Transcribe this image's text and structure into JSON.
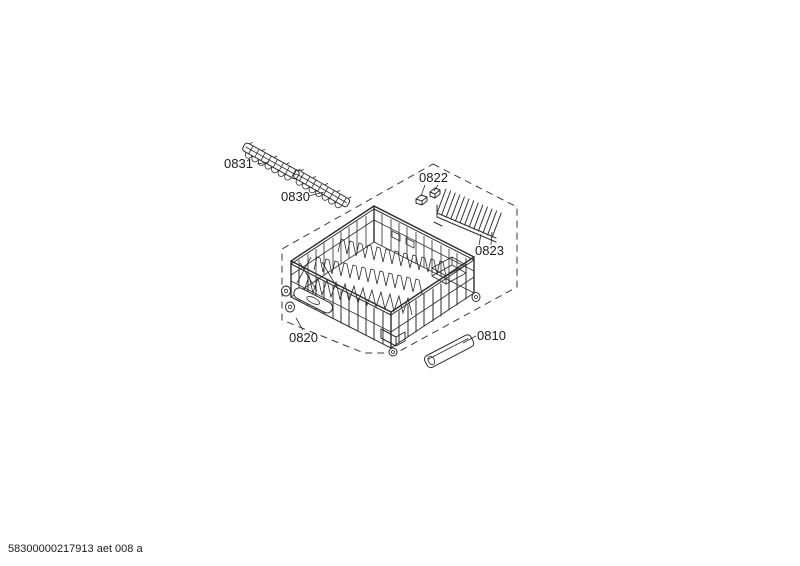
{
  "page": {
    "background_color": "#ffffff",
    "line_color": "#2d2d2d"
  },
  "diagram": {
    "kind": "exploded-parts-diagram",
    "parts": [
      {
        "ref": "0831"
      },
      {
        "ref": "0830"
      },
      {
        "ref": "0822"
      },
      {
        "ref": "0823"
      },
      {
        "ref": "0820"
      },
      {
        "ref": "0810"
      }
    ]
  },
  "footer": {
    "document_code": "58300000217913 aet 008 a"
  }
}
